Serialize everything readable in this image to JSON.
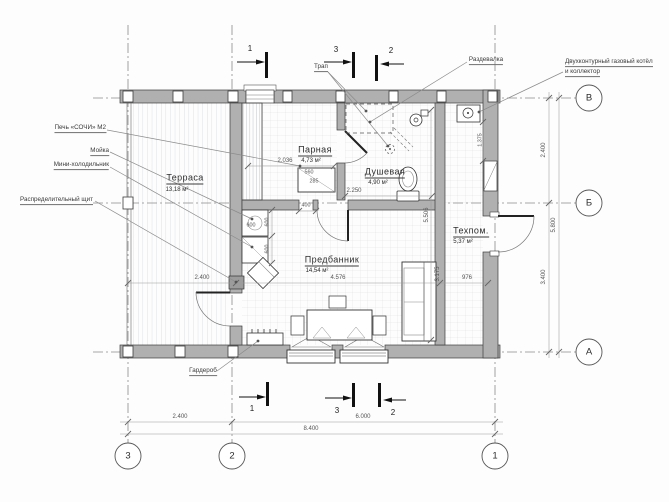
{
  "plan": {
    "rooms": [
      {
        "name": "Терраса",
        "area": "13,18 м²"
      },
      {
        "name": "Парная",
        "area": "4,73 м²"
      },
      {
        "name": "Душевая",
        "area": "4,90 м²"
      },
      {
        "name": "Предбанник",
        "area": "14,54 м²"
      },
      {
        "name": "Техпом.",
        "area": "5,37 м²"
      }
    ],
    "callouts": {
      "stove": "Печь «СОЧИ» М2",
      "sink": "Мойка",
      "fridge": "Мини-холодильник",
      "panel": "Распределительный щит",
      "drain": "Трап",
      "wardrobe": "Гардероб",
      "dressing": "Раздевалка",
      "boiler_1": "Двухконтурный газовый котёл",
      "boiler_2": "и коллектор"
    },
    "axes": {
      "rows": [
        "В",
        "Б",
        "А"
      ],
      "cols": [
        "3",
        "2",
        "1"
      ]
    },
    "sections": {
      "one": "1",
      "two": "2",
      "three": "3"
    },
    "dims": {
      "bottom_seg1": "2.400",
      "bottom_seg2": "6.000",
      "bottom_total": "8.400",
      "right_seg1": "2.400",
      "right_seg2": "3.400",
      "right_total": "5.800",
      "terrace_width": "2.400",
      "predbannik_width": "4.576",
      "tehpom_width": "976",
      "parnaya_width": "2.036",
      "dushevaya_width": "2.250",
      "stove_width": "560",
      "stove_depth": "285",
      "stove_opening": "400",
      "sink_width": "600",
      "sink_depth": "600",
      "fridge_depth": "600",
      "tehpom_length": "5.506",
      "sofa_length": "3.175",
      "boiler_offset": "1.375"
    },
    "colors": {
      "wall_fill": "#b0b0b0",
      "line": "#3d3d3d",
      "axis": "#8a8a8a"
    }
  }
}
